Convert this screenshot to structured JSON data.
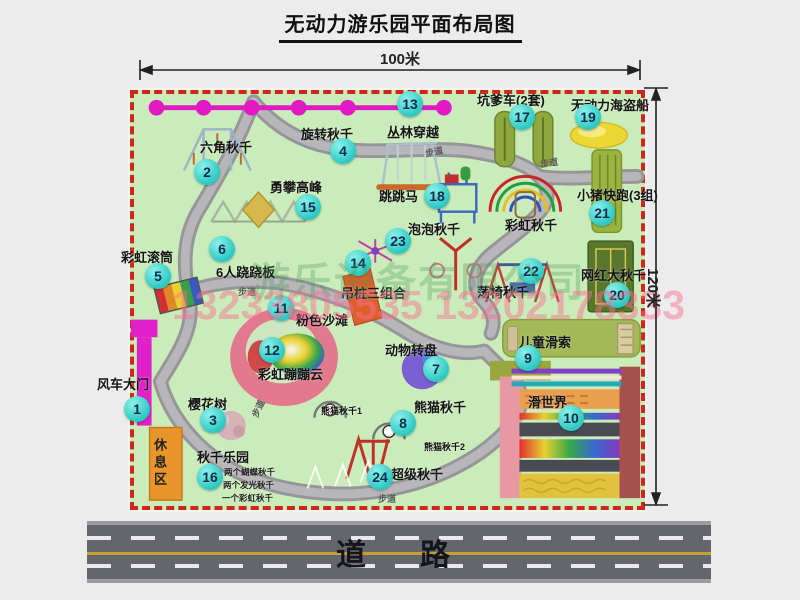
{
  "title": "无动力游乐园平面布局图",
  "scale": {
    "width_label": "100米",
    "height_label": "120米"
  },
  "road": {
    "label": "道　路"
  },
  "watermark": {
    "company": "游乐设备有限公司",
    "phone": "13233805535 13202178333"
  },
  "rest_area_label": "休息区",
  "map": {
    "items": [
      {
        "num": "1",
        "label": "风车大门",
        "lx": 97,
        "ly": 374,
        "cx": 137,
        "cy": 409
      },
      {
        "num": "2",
        "label": "六角秋千",
        "lx": 200,
        "ly": 137,
        "cx": 207,
        "cy": 172
      },
      {
        "num": "3",
        "label": "樱花树",
        "lx": 188,
        "ly": 394,
        "cx": 213,
        "cy": 420
      },
      {
        "num": "4",
        "label": "旋转秋千",
        "lx": 301,
        "ly": 124,
        "cx": 343,
        "cy": 151
      },
      {
        "num": "5",
        "label": "彩虹滚筒",
        "lx": 121,
        "ly": 247,
        "cx": 158,
        "cy": 276
      },
      {
        "num": "6",
        "label": "6人跷跷板",
        "lx": 216,
        "ly": 262,
        "cx": 222,
        "cy": 249
      },
      {
        "num": "7",
        "label": "动物转盘",
        "lx": 385,
        "ly": 340,
        "cx": 436,
        "cy": 369
      },
      {
        "num": "8",
        "label": "熊猫秋千",
        "lx": 414,
        "ly": 397,
        "cx": 403,
        "cy": 423
      },
      {
        "num": "9",
        "label": "儿童滑索",
        "lx": 519,
        "ly": 332,
        "cx": 528,
        "cy": 358
      },
      {
        "num": "10",
        "label": "滑世界",
        "lx": 528,
        "ly": 392,
        "cx": 571,
        "cy": 418
      },
      {
        "num": "11",
        "label": "粉色沙滩",
        "lx": 296,
        "ly": 310,
        "cx": 281,
        "cy": 308
      },
      {
        "num": "12",
        "label": "彩虹蹦蹦云",
        "lx": 258,
        "ly": 364,
        "cx": 272,
        "cy": 350
      },
      {
        "num": "13",
        "label": "丛林穿越",
        "lx": 387,
        "ly": 122,
        "cx": 410,
        "cy": 104
      },
      {
        "num": "14",
        "label": "吊桩三组合",
        "lx": 341,
        "ly": 283,
        "cx": 358,
        "cy": 263
      },
      {
        "num": "15",
        "label": "勇攀高峰",
        "lx": 270,
        "ly": 177,
        "cx": 308,
        "cy": 207
      },
      {
        "num": "16",
        "label": "秋千乐园",
        "lx": 197,
        "ly": 447,
        "cx": 210,
        "cy": 477,
        "notes": [
          "两个蝴蝶秋千",
          "两个发光秋千",
          "一个彩虹秋千"
        ],
        "notes_x": 224,
        "notes_y": 466
      },
      {
        "num": "17",
        "label": "坑爹车(2套)",
        "lx": 477,
        "ly": 90,
        "cx": 522,
        "cy": 117
      },
      {
        "num": "18",
        "label": "跳跳马",
        "lx": 379,
        "ly": 186,
        "cx": 437,
        "cy": 196
      },
      {
        "num": "19",
        "label": "无动力海盗船",
        "lx": 571,
        "ly": 95,
        "cx": 588,
        "cy": 117
      },
      {
        "num": "20",
        "label": "网红大秋千",
        "lx": 581,
        "ly": 265,
        "cx": 617,
        "cy": 295
      },
      {
        "num": "21",
        "label": "小猪快跑(3组)",
        "lx": 577,
        "ly": 185,
        "cx": 602,
        "cy": 213
      },
      {
        "num": "22",
        "label": "荡椅秋千",
        "lx": 477,
        "ly": 282,
        "cx": 531,
        "cy": 271
      },
      {
        "num": "23",
        "label": "泡泡秋千",
        "lx": 408,
        "ly": 219,
        "cx": 398,
        "cy": 241
      },
      {
        "num": "24",
        "label": "超级秋千",
        "lx": 391,
        "ly": 464,
        "cx": 380,
        "cy": 477
      }
    ],
    "extra_labels": [
      {
        "text": "彩虹秋千",
        "x": 505,
        "y": 215,
        "cls": ""
      },
      {
        "text": "熊猫秋千1",
        "x": 321,
        "y": 404,
        "cls": "xs"
      },
      {
        "text": "熊猫秋千2",
        "x": 424,
        "y": 440,
        "cls": "xs"
      }
    ],
    "walkway_label": "步道",
    "walkway_labels": [
      {
        "x": 425,
        "y": 145,
        "rot": -12
      },
      {
        "x": 540,
        "y": 156,
        "rot": -8
      },
      {
        "x": 238,
        "y": 285,
        "rot": 0
      },
      {
        "x": 249,
        "y": 402,
        "rot": -65
      },
      {
        "x": 378,
        "y": 492,
        "rot": 0
      }
    ]
  }
}
